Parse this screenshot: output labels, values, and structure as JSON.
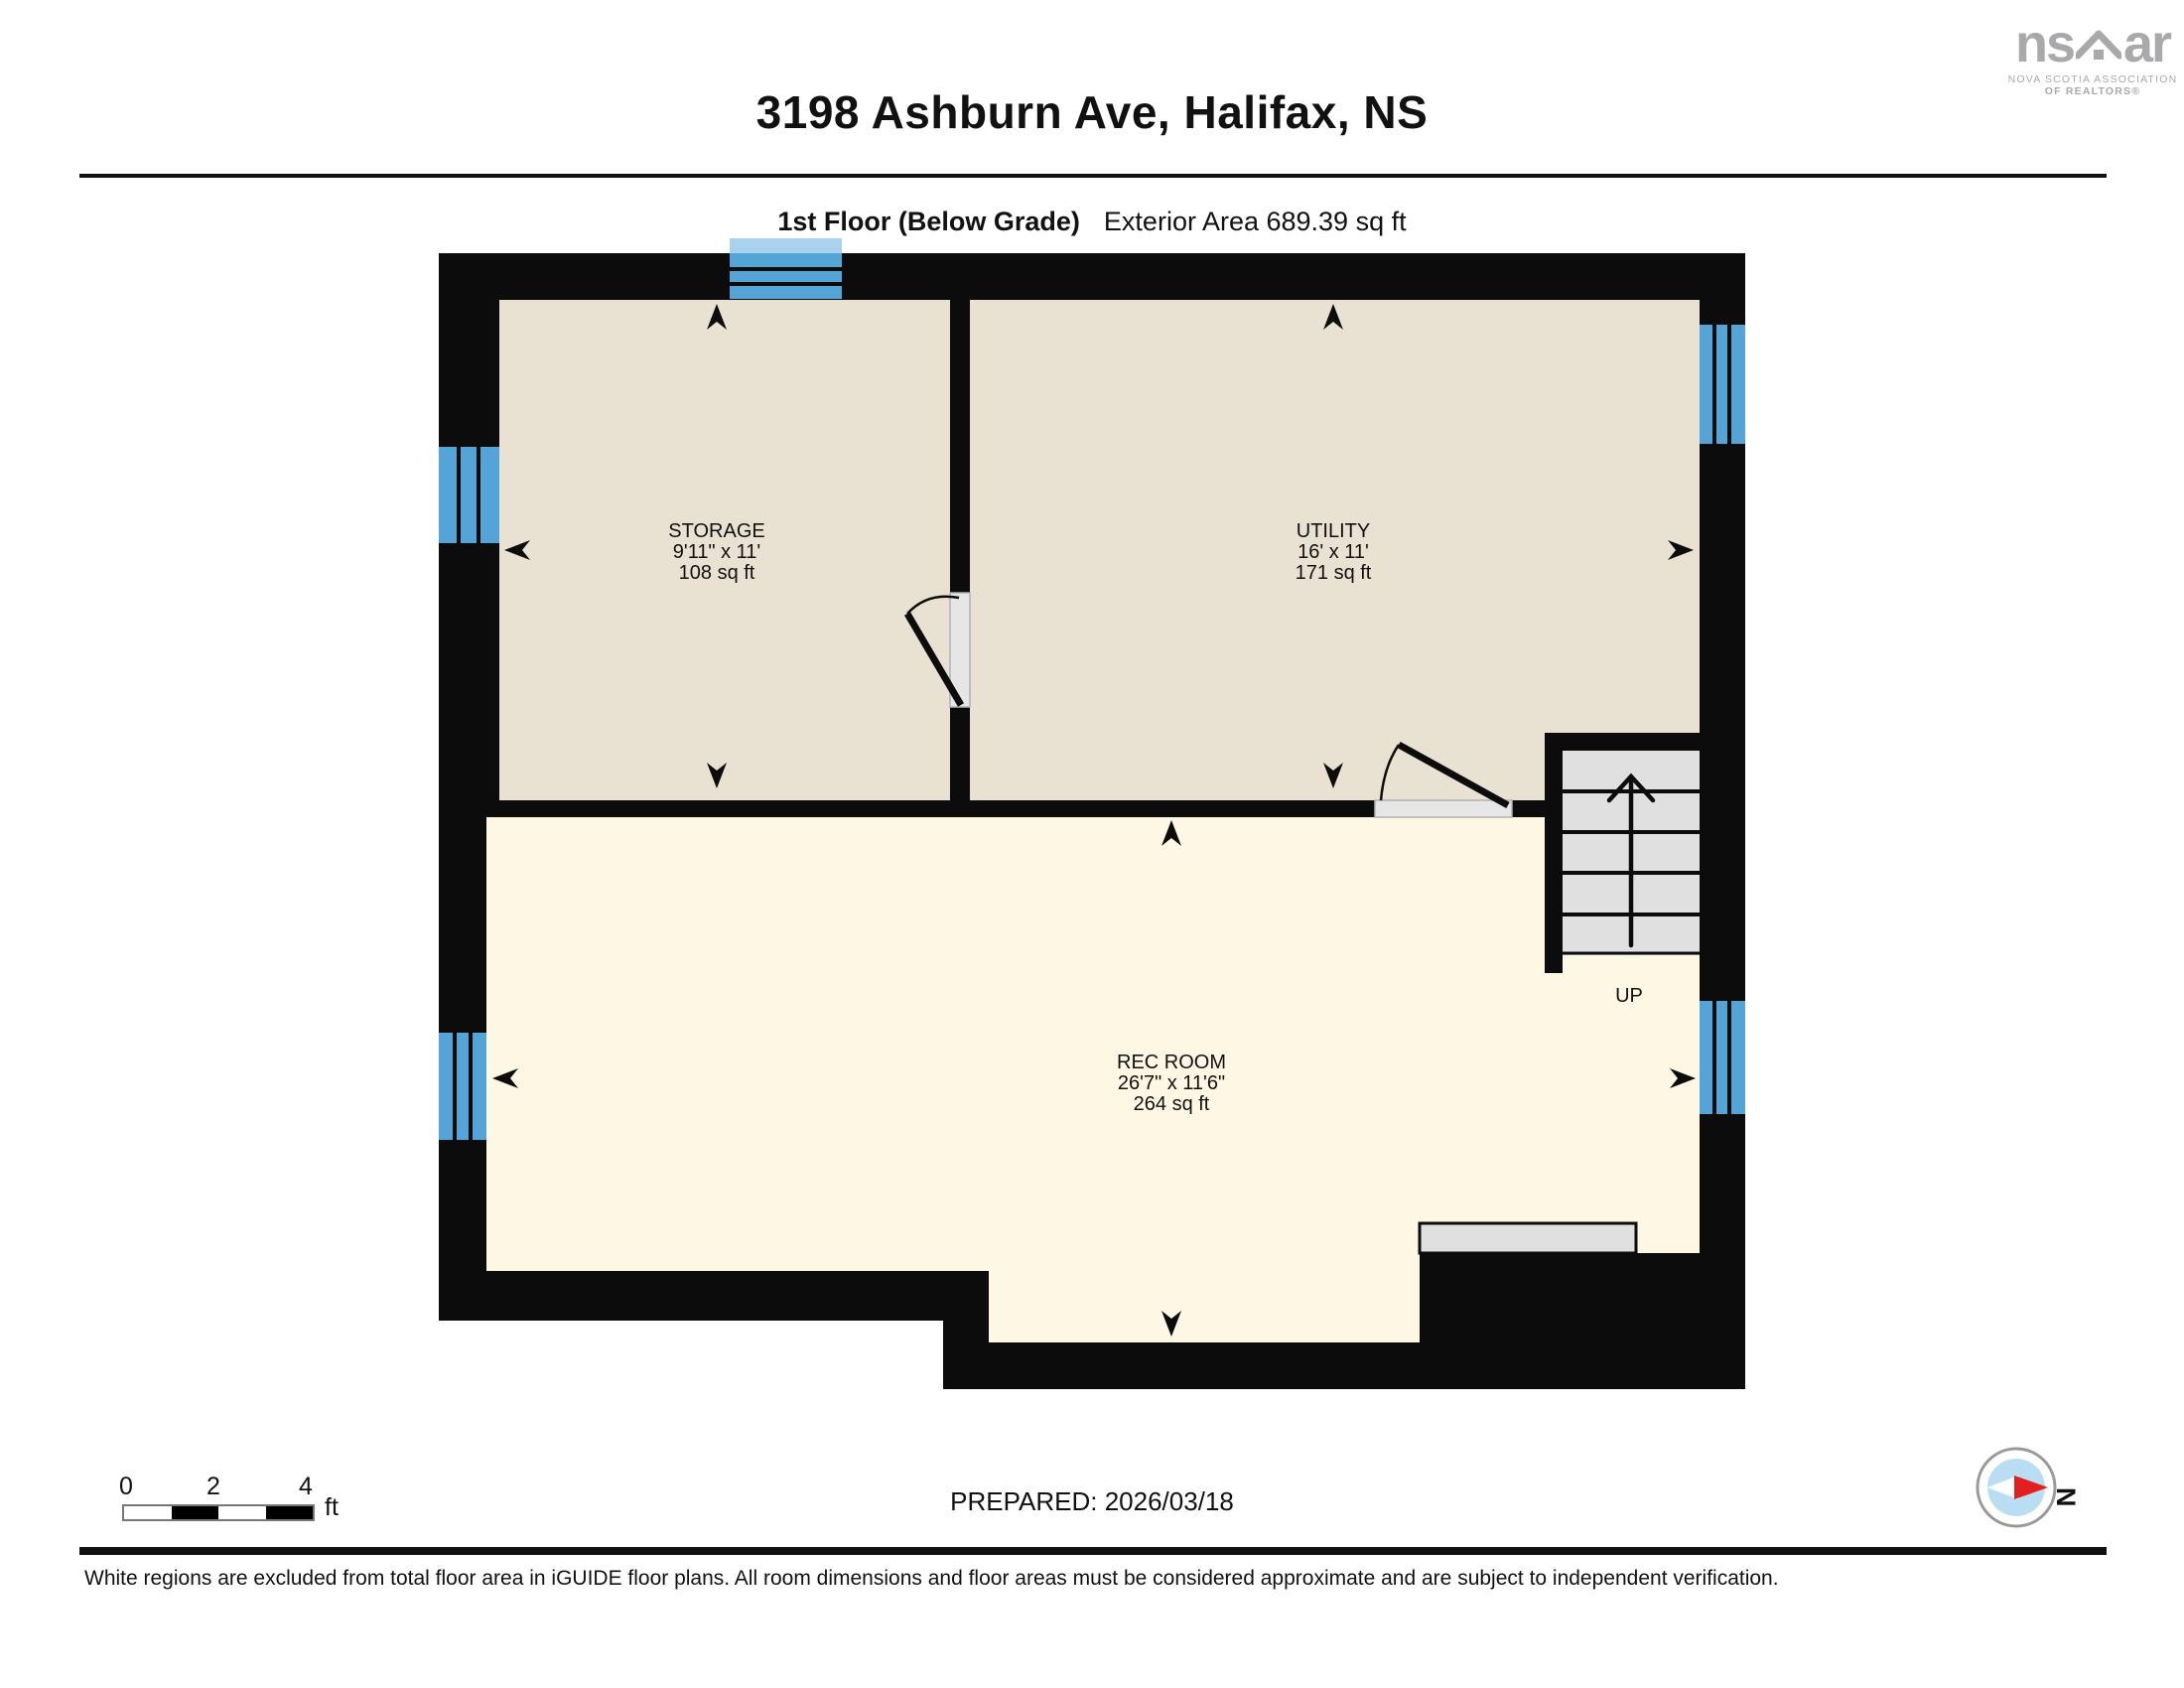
{
  "header": {
    "title": "3198 Ashburn Ave, Halifax, NS",
    "floor_label": "1st Floor (Below Grade)",
    "exterior_area": "Exterior Area 689.39 sq ft",
    "interior_area": "Interior Area 586.07 sq ft"
  },
  "logo": {
    "name_left": "ns",
    "name_right": "ar",
    "caption_line1": "NOVA SCOTIA ASSOCIATION",
    "caption_line2": "OF REALTORS®"
  },
  "rooms": [
    {
      "name": "STORAGE",
      "dimensions": "9'11\" x 11'",
      "area": "108 sq ft"
    },
    {
      "name": "UTILITY",
      "dimensions": "16' x 11'",
      "area": "171 sq ft"
    },
    {
      "name": "REC ROOM",
      "dimensions": "26'7\" x 11'6\"",
      "area": "264 sq ft"
    }
  ],
  "stairs": {
    "label": "UP"
  },
  "scale_bar": {
    "tick0": "0",
    "tick2": "2",
    "tick4": "4",
    "unit": "ft"
  },
  "prepared": "PREPARED: 2026/03/18",
  "compass": {
    "label": "N"
  },
  "footer": "White regions are excluded from total floor area in iGUIDE floor plans. All room dimensions and floor areas must be considered approximate and are subject to independent verification.",
  "colors": {
    "wall": "#0c0c0c",
    "room_beige": "#e9e1d2",
    "room_cream": "#fdf7e4",
    "window_blue": "#54a4d8",
    "window_blue_light": "#aad2ec",
    "stair_gray": "#e0e0e0",
    "compass_red": "#e31f1f",
    "compass_blue": "#b9ddf2",
    "logo_gray": "#a9a9ab"
  }
}
